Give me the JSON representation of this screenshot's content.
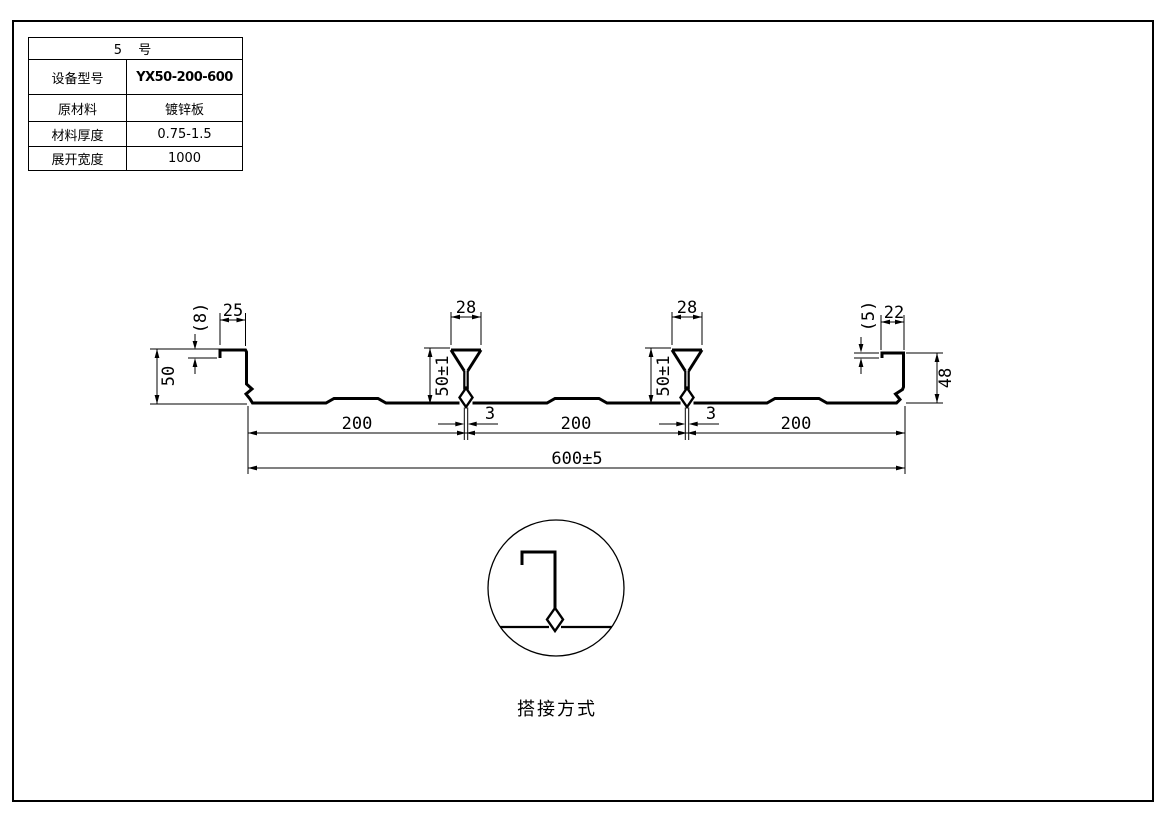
{
  "table": {
    "title": "5  号",
    "rows": [
      {
        "label": "设备型号",
        "value": "YX50-200-600"
      },
      {
        "label": "原材料",
        "value": "镀锌板"
      },
      {
        "label": "材料厚度",
        "value": "0.75-1.5"
      },
      {
        "label": "展开宽度",
        "value": "1000"
      }
    ]
  },
  "dims": {
    "left_flange_top": "25",
    "left_hook": "(8)",
    "left_height": "50",
    "rib_width": "28",
    "rib_height": "50±1",
    "slot": "3",
    "pitch": "200",
    "overall": "600±5",
    "right_flange_top": "22",
    "right_hook": "(5)",
    "right_height": "48"
  },
  "detail": {
    "caption": "搭接方式"
  },
  "colors": {
    "line": "#000000",
    "background": "#ffffff"
  }
}
